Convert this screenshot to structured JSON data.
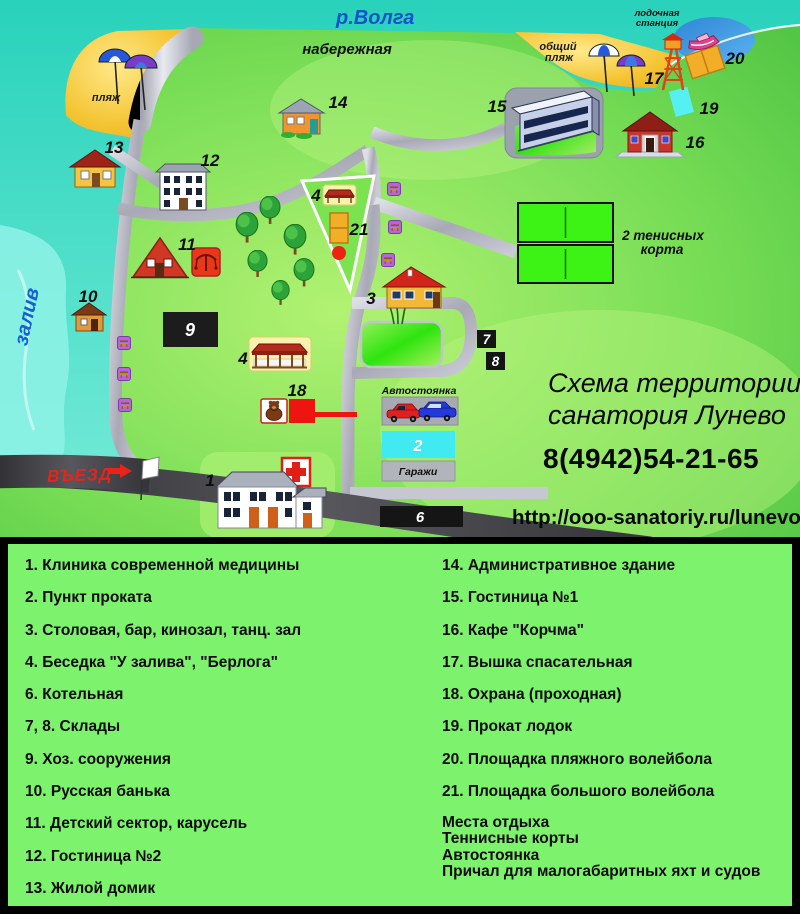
{
  "map": {
    "river_label": "р.Волга",
    "embankment_label": "набережная",
    "beach_label": "пляж",
    "public_beach_line1": "общий",
    "public_beach_line2": "пляж",
    "boat_station_line1": "лодочная",
    "boat_station_line2": "станция",
    "bay_label": "залив",
    "entrance_label": "ВЪЕЗД",
    "tennis_line1": "2 тенисных",
    "tennis_line2": "корта",
    "parking_label": "Автостоянка",
    "garages_label": "Гаражи",
    "title_line1": "Схема территории",
    "title_line2": "санатория Лунево",
    "phone": "8(4942)54-21-65",
    "url": "http://ooo-sanatoriy.ru/lunevo",
    "numbers": {
      "b1": "1",
      "b2": "2",
      "b3": "3",
      "b4a": "4",
      "b4b": "4",
      "b6": "6",
      "b7": "7",
      "b8": "8",
      "b9": "9",
      "b10": "10",
      "b11": "11",
      "b12": "12",
      "b13": "13",
      "b14": "14",
      "b15": "15",
      "b16": "16",
      "b17": "17",
      "b18": "18",
      "b19": "19",
      "b20": "20",
      "b21": "21"
    }
  },
  "legend": {
    "left": [
      "1. Клиника современной медицины",
      "2. Пункт проката",
      "3. Столовая, бар, кинозал, танц. зал",
      "4. Беседка  \"У залива\", \"Берлога\"",
      "6. Котельная",
      "7, 8. Склады",
      "9. Хоз. сооружения",
      "10. Русская банька",
      "11. Детский сектор, карусель",
      "12. Гостиница №2",
      "13. Жилой домик"
    ],
    "right": [
      "14. Административное здание",
      "15. Гостиница №1",
      "16. Кафе \"Корчма\"",
      "17. Вышка спасательная",
      "18. Охрана (проходная)",
      "19. Прокат лодок",
      "20. Площадка пляжного волейбола",
      "21. Площадка большого волейбола"
    ],
    "extra": [
      "Места отдыха",
      "Теннисные корты",
      "Автостоянка",
      "Причал для малогабаритных яхт и судов"
    ]
  },
  "colors": {
    "water_teal": "#35d9c2",
    "bay_cyan": "#8ef2e6",
    "inlet_blue": "#3a8ad8",
    "land_green": "#5ecb4b",
    "legend_green": "#7df26d",
    "road_silver": "#b7b8c3",
    "road_dark": "#3c3c40",
    "beach_yellow": "#f6ca37",
    "court_green": "#3df215",
    "box_black": "#161616",
    "parking_cyan": "#41e9f0",
    "accent_red": "#e8231a",
    "orange": "#f2ae28",
    "river_blue": "#1452cc"
  }
}
